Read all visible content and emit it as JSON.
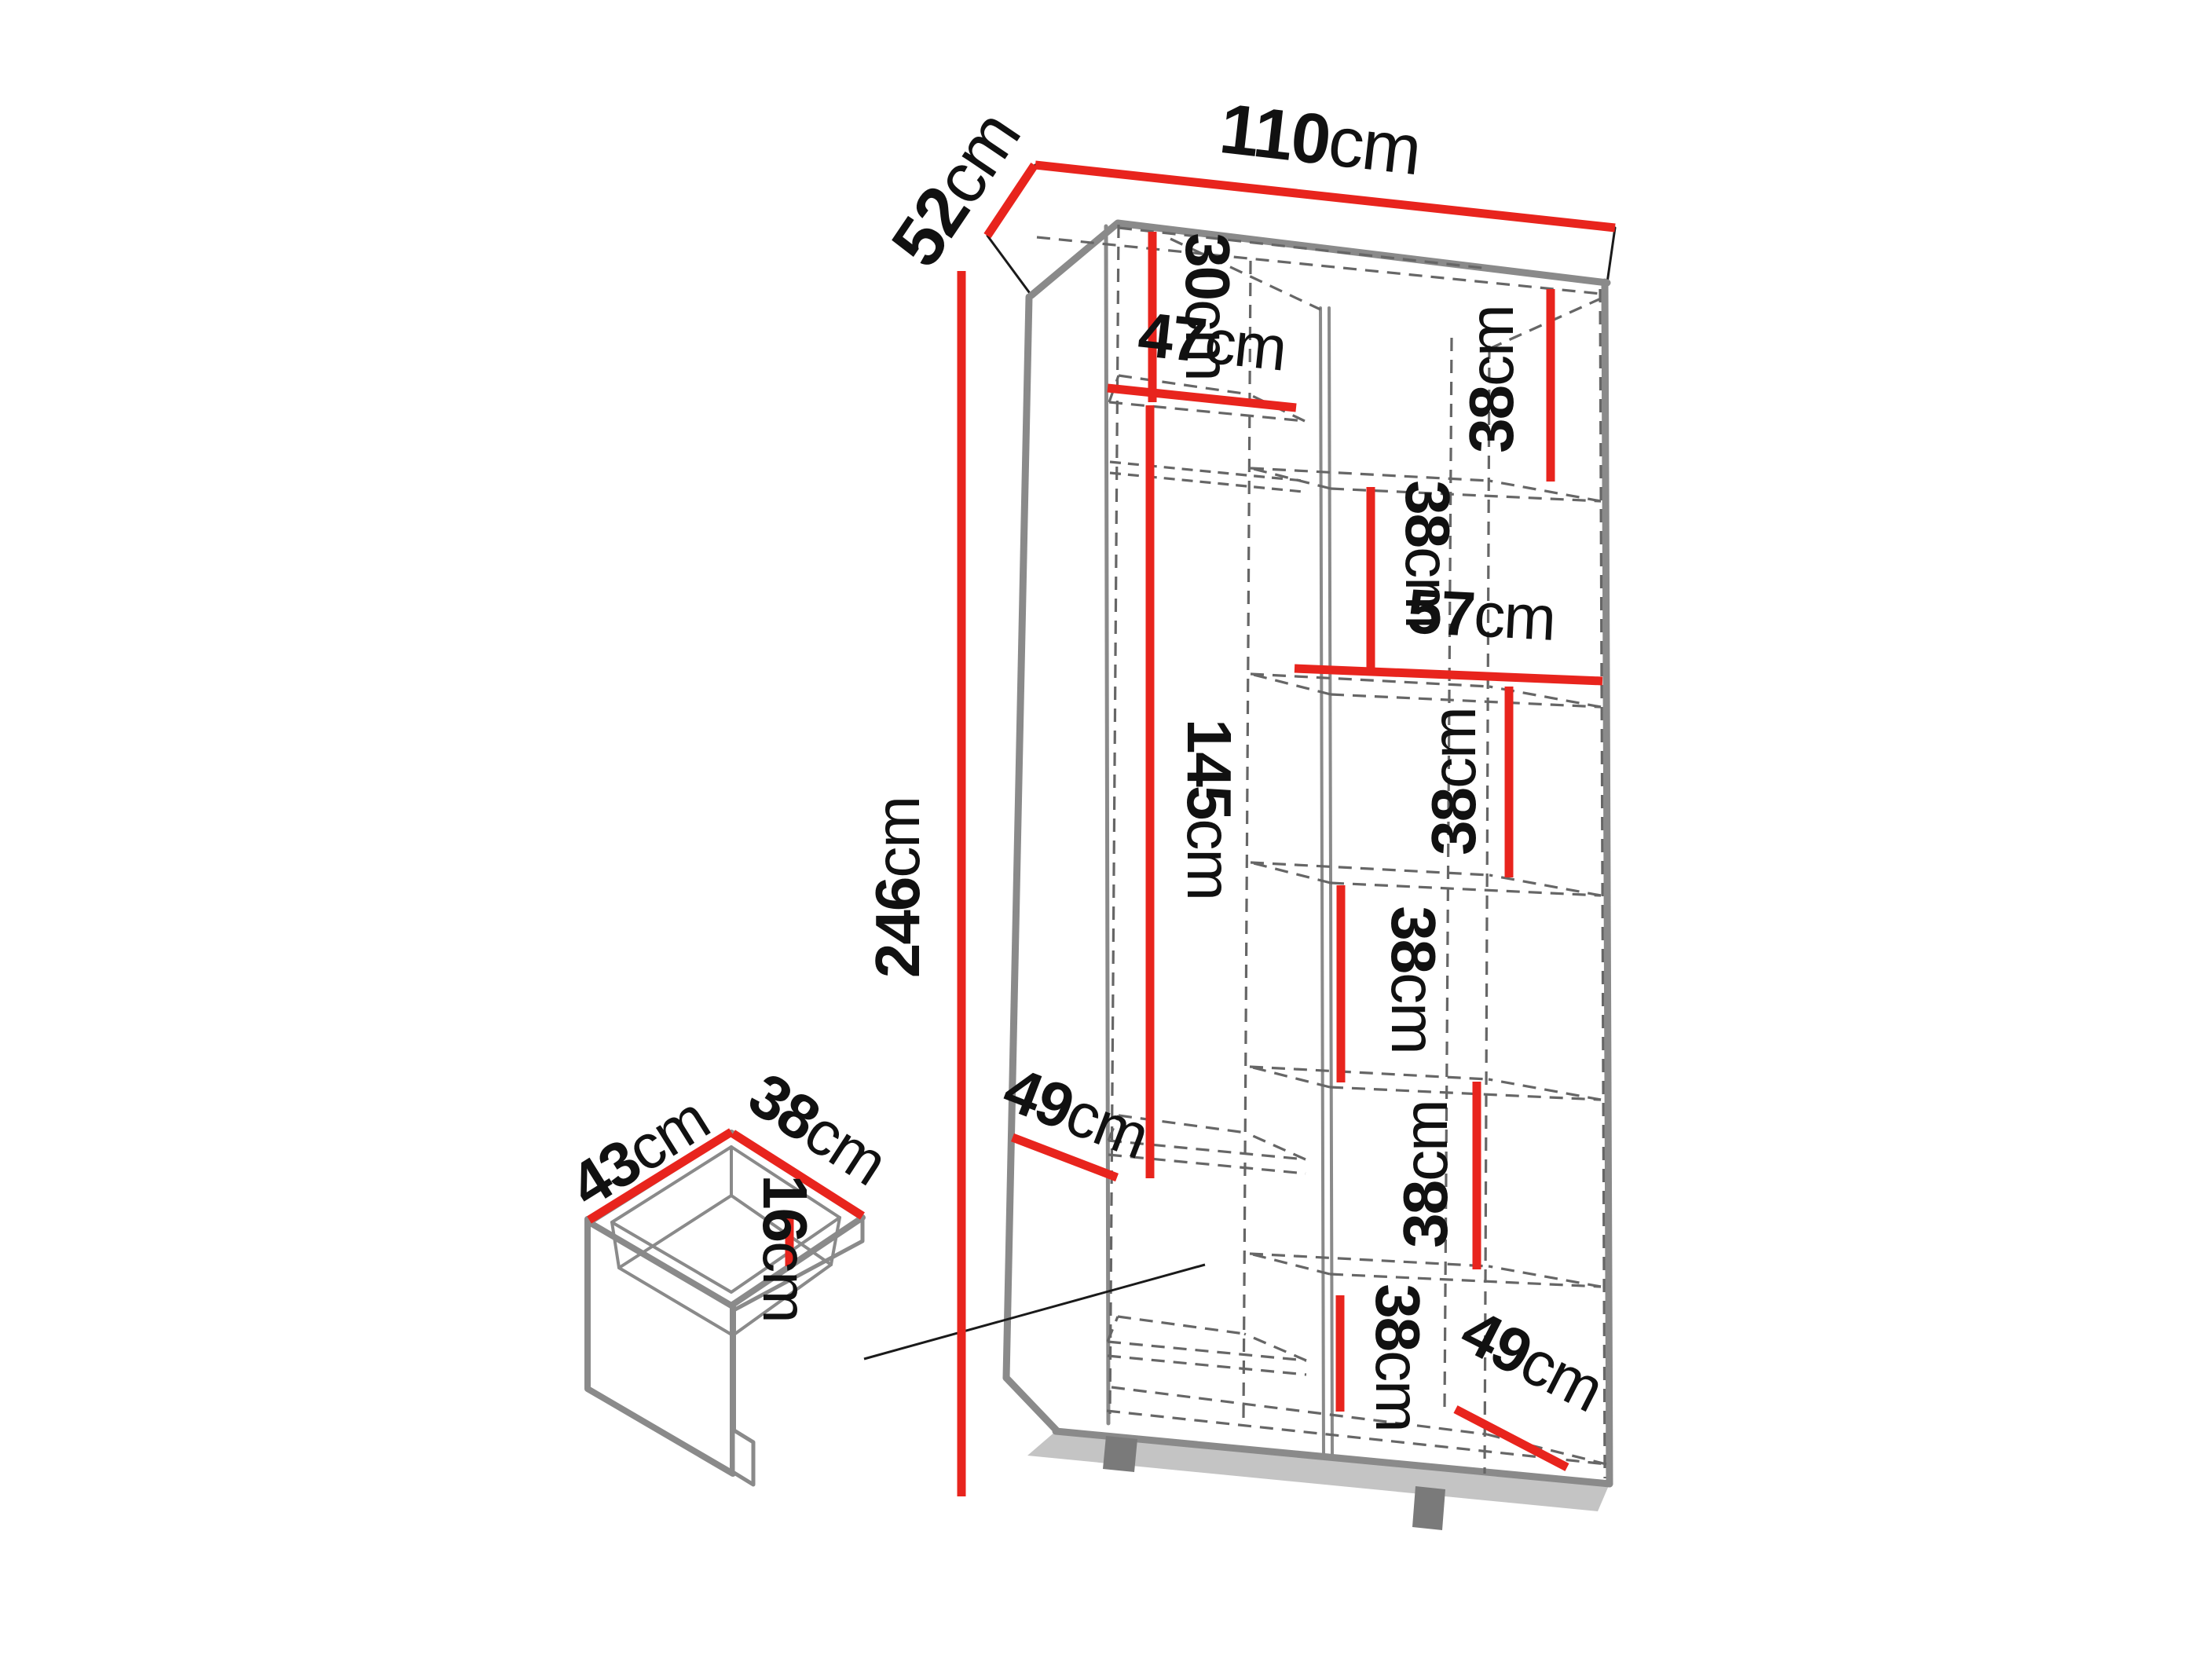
{
  "page": {
    "background": "#ffffff"
  },
  "colors": {
    "dimension_red": "#e8241d",
    "edge_gray": "#8a8a8a",
    "dash_gray": "#666666",
    "shadow_gray": "#c4c4c4",
    "text_black": "#111111"
  },
  "diagram": {
    "kind": "wardrobe-interior-dimension-diagram",
    "unit": "cm",
    "overall": {
      "width_cm": 110,
      "depth_cm": 52,
      "height_cm": 246
    },
    "dimensions": {
      "width110": {
        "value": "110",
        "unit": "cm"
      },
      "depth52": {
        "value": "52",
        "unit": "cm"
      },
      "height246": {
        "value": "246",
        "unit": "cm"
      },
      "top30": {
        "value": "30",
        "unit": "cm"
      },
      "shelf47": {
        "value": "47",
        "unit": "cm"
      },
      "hang145": {
        "value": "145",
        "unit": "cm"
      },
      "depth49left": {
        "value": "49",
        "unit": "cm"
      },
      "right57": {
        "value": "57",
        "unit": "cm"
      },
      "shelf38a": {
        "value": "38",
        "unit": "cm"
      },
      "shelf38b": {
        "value": "38",
        "unit": "cm"
      },
      "shelf38c": {
        "value": "38",
        "unit": "cm"
      },
      "shelf38d": {
        "value": "38",
        "unit": "cm"
      },
      "shelf38e": {
        "value": "38",
        "unit": "cm"
      },
      "shelf38f": {
        "value": "38",
        "unit": "cm"
      },
      "depth49right": {
        "value": "49",
        "unit": "cm"
      },
      "drawer43": {
        "value": "43",
        "unit": "cm"
      },
      "drawer38": {
        "value": "38",
        "unit": "cm"
      },
      "drawer16": {
        "value": "16",
        "unit": "cm"
      }
    }
  }
}
